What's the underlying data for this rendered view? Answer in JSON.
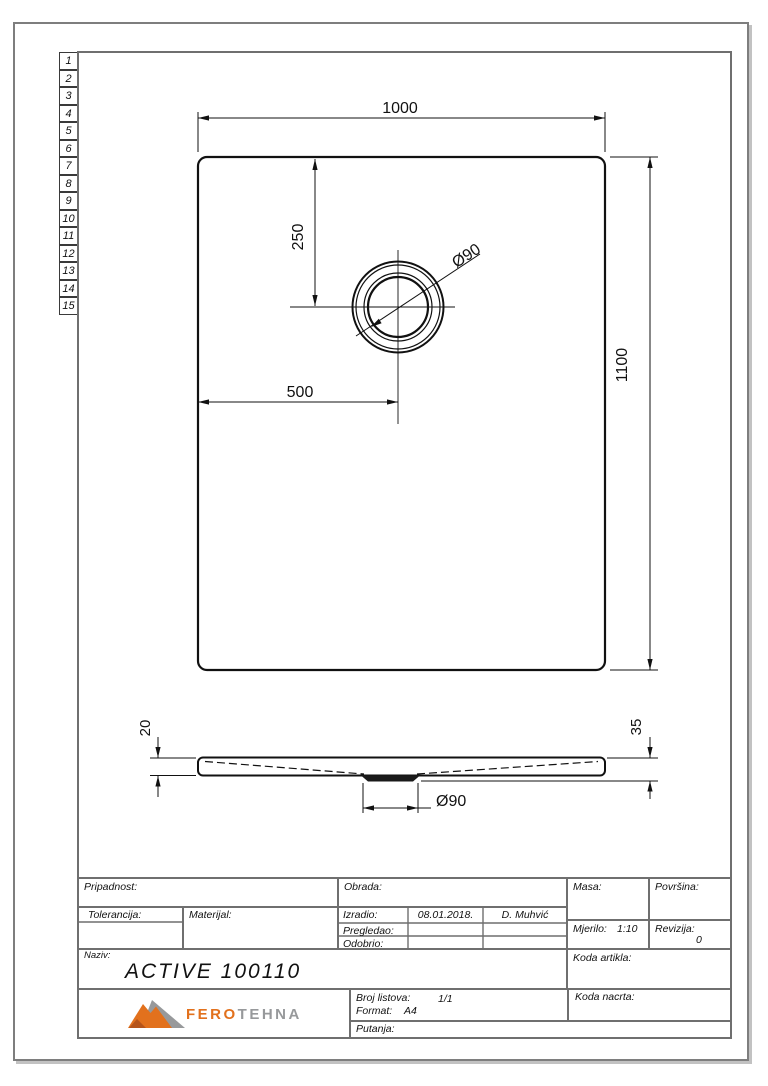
{
  "drawing": {
    "sheet_rows": [
      "1",
      "2",
      "3",
      "4",
      "5",
      "6",
      "7",
      "8",
      "9",
      "10",
      "11",
      "12",
      "13",
      "14",
      "15"
    ],
    "top_view": {
      "dim_width": "1000",
      "dim_height": "1100",
      "dim_offset_x": "500",
      "dim_offset_y": "250",
      "dim_drain": "Ø90"
    },
    "section_view": {
      "dim_edge_thickness": "20",
      "dim_total_depth": "35",
      "dim_drain": "Ø90"
    }
  },
  "title_block": {
    "pripadnost_label": "Pripadnost:",
    "tolerancija_label": "Tolerancija:",
    "materijal_label": "Materijal:",
    "obrada_label": "Obrada:",
    "izradio_label": "Izradio:",
    "izradio_date": "08.01.2018.",
    "izradio_name": "D. Muhvić",
    "pregledao_label": "Pregledao:",
    "odobrio_label": "Odobrio:",
    "masa_label": "Masa:",
    "povrsina_label": "Površina:",
    "mjerilo_label": "Mjerilo:",
    "mjerilo_value": "1:10",
    "revizija_label": "Revizija:",
    "revizija_value": "0",
    "koda_artikla_label": "Koda artikla:",
    "naziv_label": "Naziv:",
    "naziv_value": "ACTIVE 100110",
    "broj_listova_label": "Broj listova:",
    "broj_listova_value": "1/1",
    "format_label": "Format:",
    "format_value": "A4",
    "putanja_label": "Putanja:",
    "koda_nacrta_label": "Koda nacrta:"
  },
  "logo": {
    "fero": "FERO",
    "tehna": "TEHNA",
    "orange": "#e2711d",
    "gray": "#97999b"
  }
}
